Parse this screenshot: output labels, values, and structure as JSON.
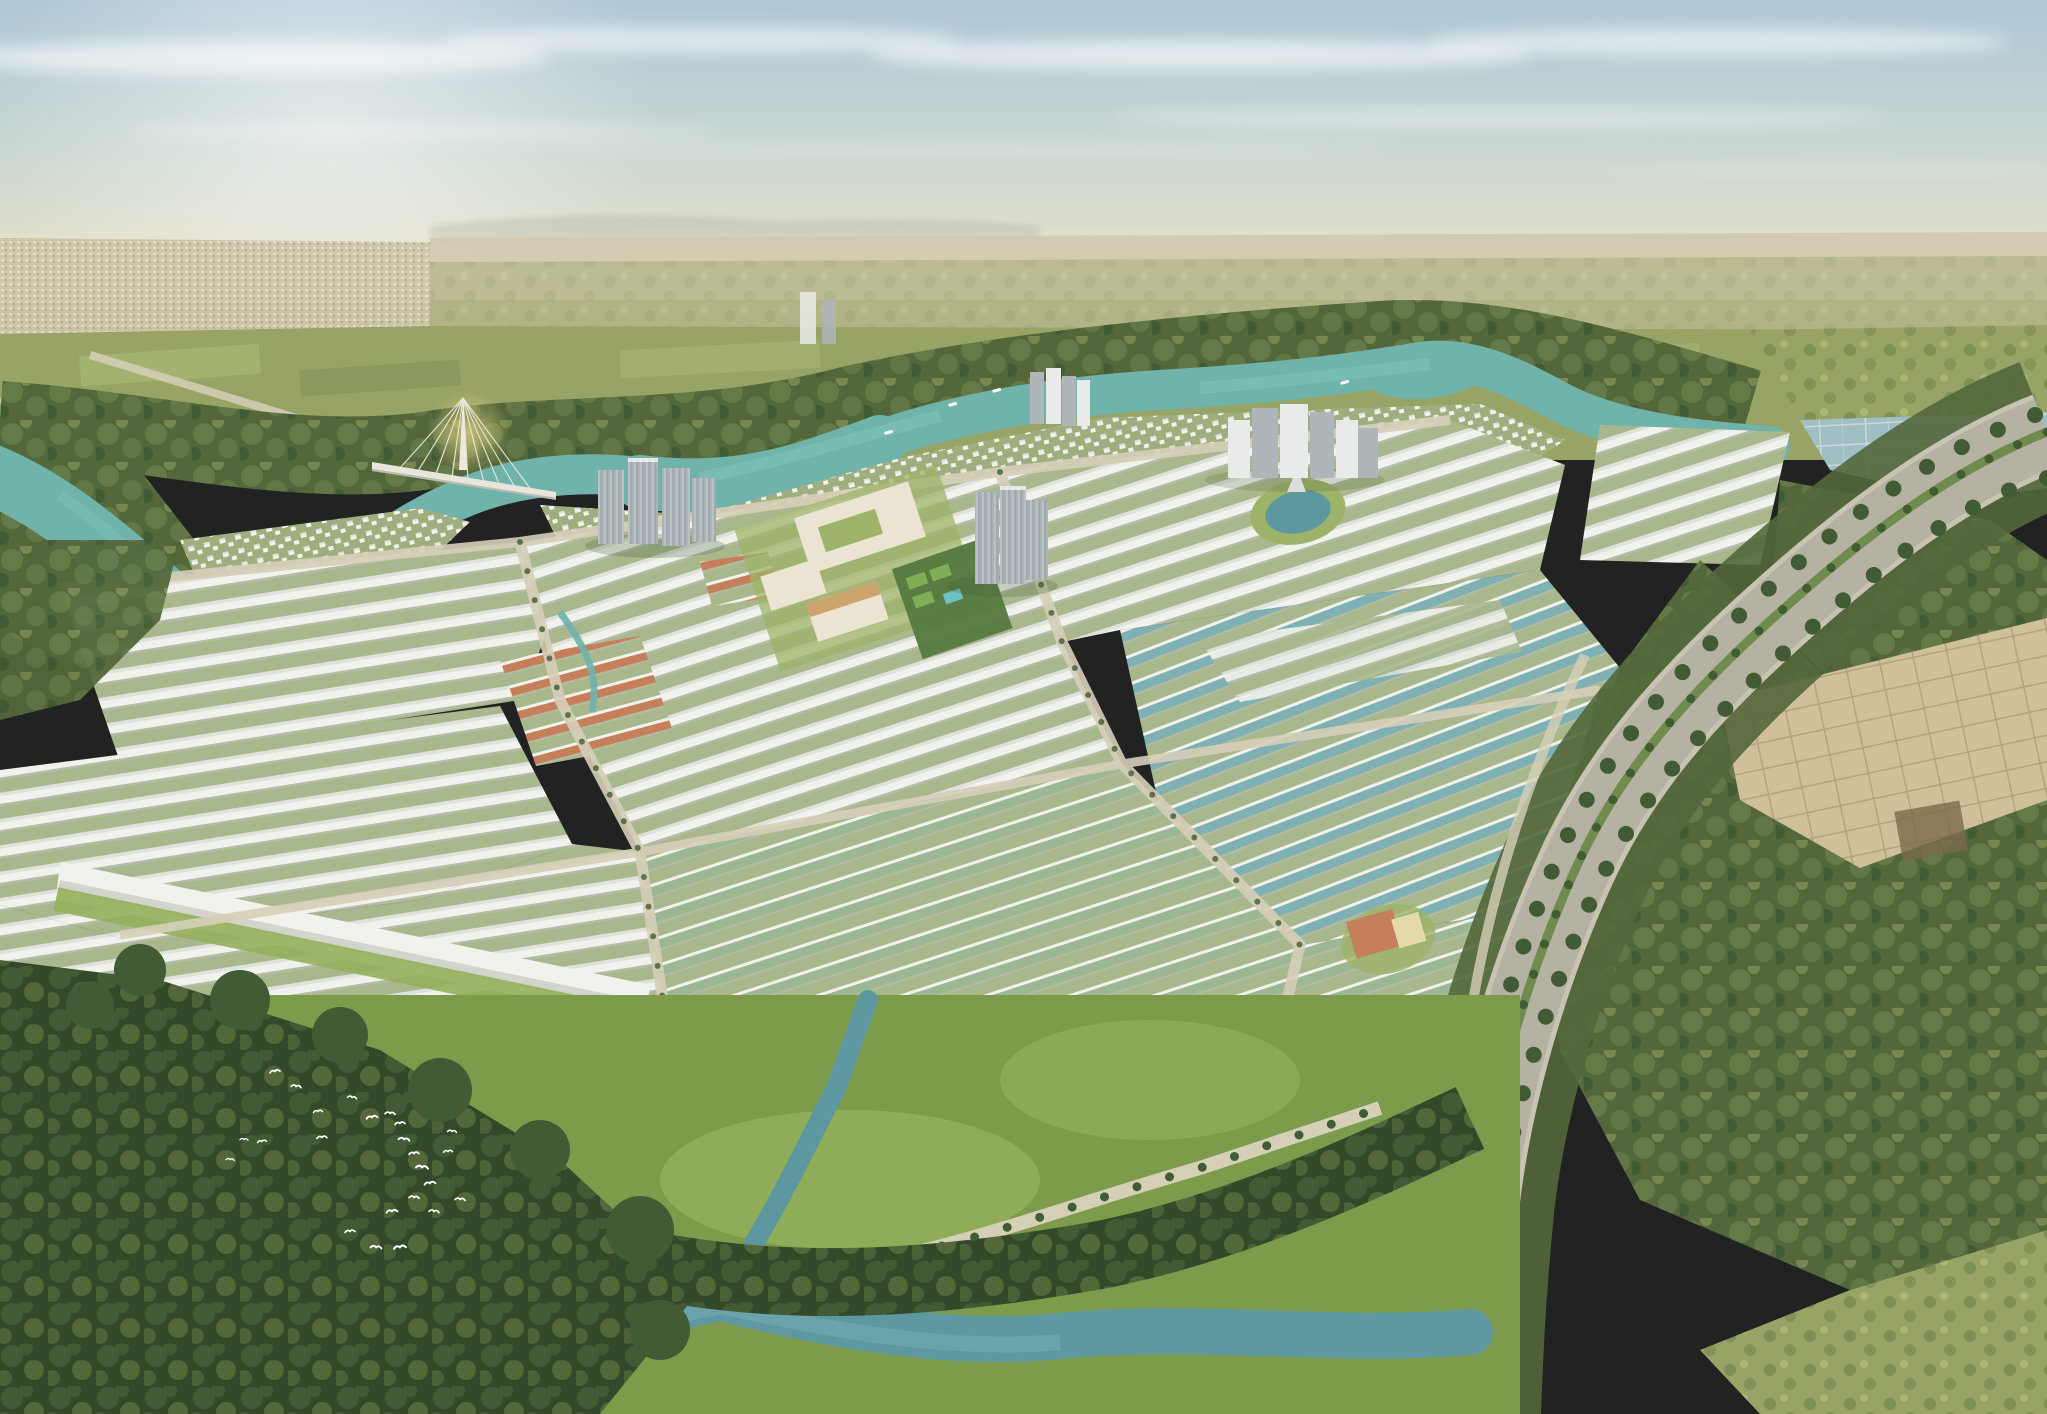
{
  "scene": {
    "type": "aerial-architectural-render",
    "description": "Aerial rendering of a large riverside master-planned township: grids of white shophouse rows, sage-green and teal roofed housing clusters, several high-rise tower groups, a cable-stayed bridge over a winding teal river, a curving tree-lined boulevard on the right, mangrove forest, meadows, a foreground stream and a flock of white egrets.",
    "time_of_day": "hazy daylight",
    "birds": [
      [
        275,
        1072,
        -10,
        1
      ],
      [
        296,
        1087,
        8,
        1
      ],
      [
        318,
        1112,
        -6,
        0.9
      ],
      [
        244,
        1140,
        4,
        0.8
      ],
      [
        262,
        1142,
        -8,
        0.9
      ],
      [
        230,
        1160,
        6,
        0.8
      ],
      [
        322,
        1138,
        -4,
        1
      ],
      [
        352,
        1098,
        10,
        0.9
      ],
      [
        372,
        1118,
        -8,
        1.1
      ],
      [
        390,
        1114,
        4,
        1
      ],
      [
        400,
        1124,
        -6,
        1
      ],
      [
        404,
        1140,
        8,
        1.1
      ],
      [
        414,
        1154,
        -4,
        1
      ],
      [
        422,
        1168,
        6,
        1.2
      ],
      [
        430,
        1184,
        -8,
        1.1
      ],
      [
        414,
        1198,
        4,
        1
      ],
      [
        392,
        1212,
        -6,
        1.1
      ],
      [
        434,
        1212,
        8,
        1
      ],
      [
        448,
        1152,
        -4,
        0.9
      ],
      [
        452,
        1132,
        6,
        0.9
      ],
      [
        400,
        1248,
        -8,
        1.2
      ],
      [
        376,
        1248,
        6,
        1.1
      ],
      [
        350,
        1232,
        -5,
        1
      ],
      [
        460,
        1200,
        5,
        1
      ]
    ],
    "boats": [
      [
        948,
        404
      ],
      [
        992,
        390
      ],
      [
        1340,
        382
      ],
      [
        884,
        432
      ]
    ]
  },
  "palette": {
    "skyTop": "#aec7d6",
    "skyMid": "#c9d6d2",
    "skyLow": "#e0dfca",
    "horizonGlow": "#efe8cd",
    "cloudWhite": "#ffffff",
    "hazeBand": "#e8e5d2",
    "hillHaze": "#b4bbae",
    "distantCity": "#cfc6aa",
    "citySpeckLight": "#e6dec6",
    "citySpeckDark": "#b2a88a",
    "fieldOlive": "#98a366",
    "fieldLight": "#aab873",
    "fieldDark": "#7e8f55",
    "scrub": "#75874e",
    "forestMid": "#647a47",
    "forestMidDark": "#53673b",
    "forestDark": "#415c34",
    "forestDarker": "#33492a",
    "riverTeal": "#6fb3ab",
    "riverDeep": "#55948d",
    "riverBright": "#84c5bb",
    "streamBlue": "#5d98a0",
    "streamLight": "#74adb2",
    "meadow": "#7d9c4b",
    "meadowLight": "#93b05c",
    "wall": "#f1f2ec",
    "roofLight": "#dfe1dc",
    "rowShadow": "#b9bcb2",
    "rowGreenBase": "#a9b88c",
    "villaBase": "#9fae7e",
    "roofSage": "#9cb794",
    "roofTeal": "#7fb0b4",
    "roofOrange": "#c5805b",
    "towerGray": "#aeb6ba",
    "towerDark": "#8f999e",
    "towerWhite": "#e8ebe9",
    "tanWall": "#ece4d2",
    "tanRoof": "#cda36e",
    "civicLawn": "#9db36a",
    "roadBeige": "#d6cfb8",
    "curb": "#c8c3b2",
    "boulevardGray": "#b5b1a3",
    "medianGreen": "#6f8c4e",
    "palmGreen": "#3f5c33",
    "parcelBeige": "#cfc09a",
    "parcelLine": "#b2a37a",
    "parcelDark": "#7a6a4a",
    "pondAqua": "#9fbfc4",
    "pondLine": "#c9d9d8",
    "poolAqua": "#6fc0c4",
    "sandBeige": "#e6d9a8",
    "glowGold": "#f0d98a",
    "courtGreen": "#55793f",
    "courtLight": "#7fae57",
    "birdWhite": "#ffffff",
    "bridgeWhite": "#ece9de",
    "deckWhite": "#e8e6da"
  }
}
